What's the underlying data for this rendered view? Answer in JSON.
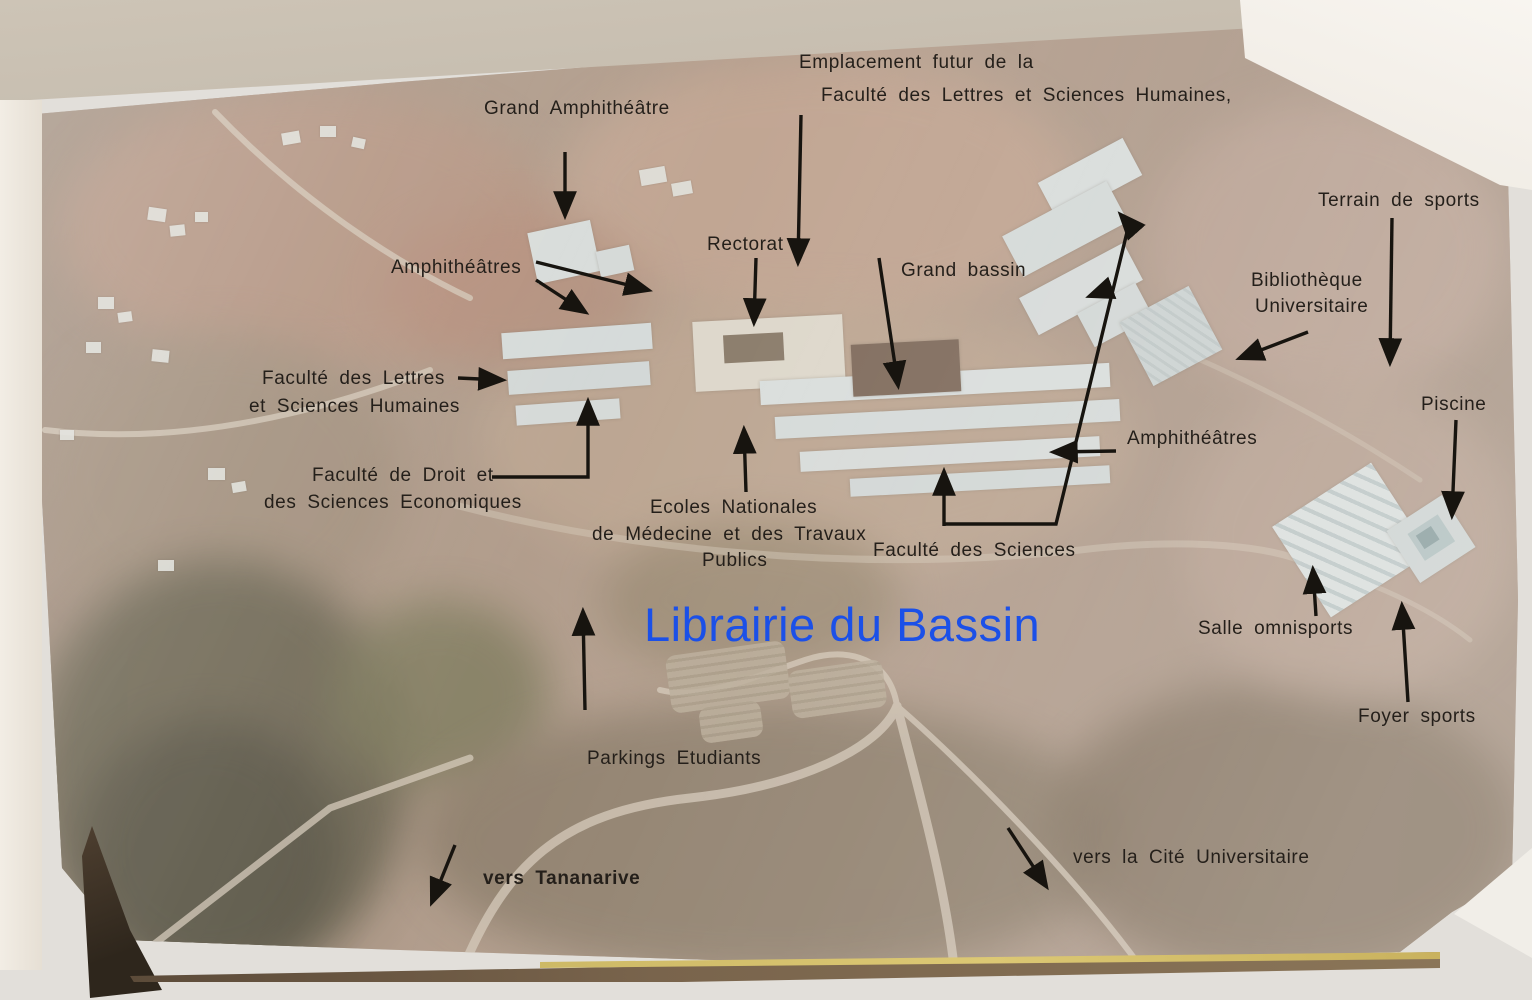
{
  "watermark": {
    "text": "Librairie du Bassin",
    "color": "#1b50e8"
  },
  "labels": {
    "emplacement_line1": "Emplacement futur de la",
    "emplacement_line2": "Faculté des Lettres et Sciences Humaines,",
    "grand_amphitheatre": "Grand Amphithéâtre",
    "amphitheatres_left": "Amphithéâtres",
    "rectorat": "Rectorat",
    "grand_bassin": "Grand bassin",
    "terrain_de_sports": "Terrain de sports",
    "bibliotheque_line1": "Bibliothèque",
    "bibliotheque_line2": "Universitaire",
    "faculte_lettres_line1": "Faculté des Lettres",
    "faculte_lettres_line2": "et Sciences Humaines",
    "piscine": "Piscine",
    "amphitheatres_right": "Amphithéâtres",
    "faculte_droit_line1": "Faculté de Droit et",
    "faculte_droit_line2": "des Sciences Economiques",
    "ecoles_line1": "Ecoles Nationales",
    "ecoles_line2": "de Médecine et des Travaux",
    "ecoles_line3": "Publics",
    "faculte_sciences": "Faculté des Sciences",
    "salle_omnisports": "Salle omnisports",
    "foyer_sports": "Foyer sports",
    "parkings_etudiants": "Parkings Etudiants",
    "vers_tananarive": "vers Tananarive",
    "vers_cite_universitaire": "vers la Cité Universitaire"
  },
  "colors": {
    "label_text": "#241f1a",
    "watermark_blue": "#1b50e8",
    "arrow_black": "#17140f",
    "building_blue": "#d9e2e4",
    "bassin_dark": "#6d5647",
    "terrain_base": "#a68f7d",
    "page_edge_beige": "#c7beb0",
    "backdrop_gray": "#e2dfda"
  }
}
